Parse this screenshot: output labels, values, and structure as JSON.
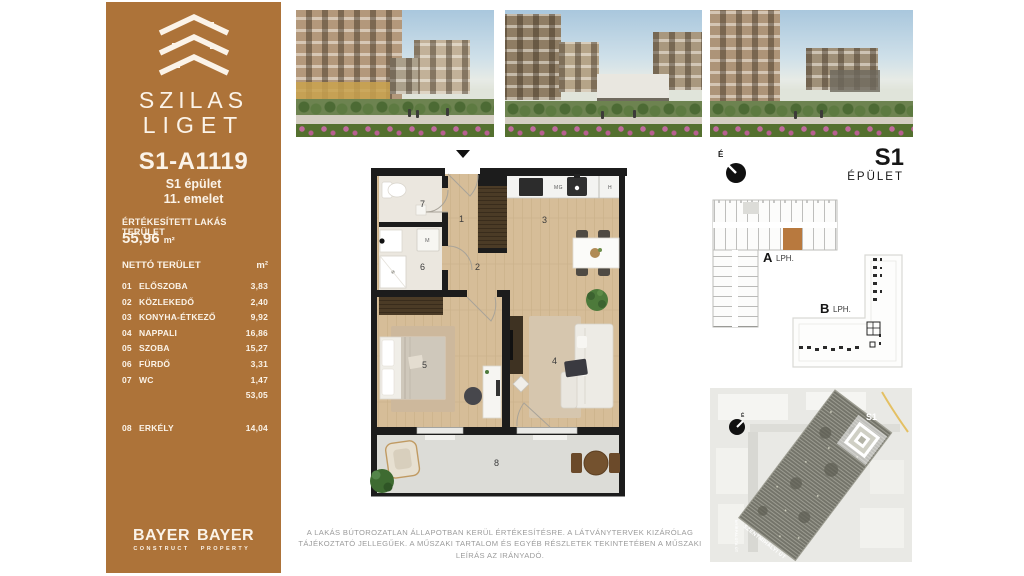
{
  "sidebar": {
    "accent_color": "#ad7339",
    "logo": {
      "line1": "SZILAS",
      "line2": "LIGET"
    },
    "unit_id": "S1-A1119",
    "building": "S1 épület",
    "floor": "11. emelet",
    "sold_area_label": "ÉRTÉKESÍTETT LAKÁS TERÜLET",
    "sold_area_value": "55,96",
    "sold_area_unit": "m²",
    "net_area_label": "NETTÓ TERÜLET",
    "net_area_unit": "m²",
    "rooms": [
      {
        "num": "01",
        "name": "ELŐSZOBA",
        "area": "3,83"
      },
      {
        "num": "02",
        "name": "KÖZLEKEDŐ",
        "area": "2,40"
      },
      {
        "num": "03",
        "name": "KONYHA-ÉTKEZŐ",
        "area": "9,92"
      },
      {
        "num": "04",
        "name": "NAPPALI",
        "area": "16,86"
      },
      {
        "num": "05",
        "name": "SZOBA",
        "area": "15,27"
      },
      {
        "num": "06",
        "name": "FÜRDŐ",
        "area": "3,31"
      },
      {
        "num": "07",
        "name": "WC",
        "area": "1,47"
      }
    ],
    "net_total": "53,05",
    "balcony_row": {
      "num": "08",
      "name": "ERKÉLY",
      "area": "14,04"
    },
    "brand1": {
      "name": "BAYER",
      "sub": "CONSTRUCT"
    },
    "brand2": {
      "name": "BAYER",
      "sub": "PROPERTY"
    }
  },
  "header_right": {
    "compass_letter": "É",
    "building_code": "S1",
    "building_label": "ÉPÜLET"
  },
  "schematic": {
    "a_label": "A",
    "a_sub": "LPH.",
    "b_label": "B",
    "b_sub": "LPH.",
    "highlight_color": "#b8793e"
  },
  "site_map": {
    "building_tag": "S1",
    "street1": "SZENTMIHÁLYI ÚT",
    "street2": "NYÍRPALOTA ÚT",
    "compass_letter": "É"
  },
  "floorplan": {
    "room_labels": [
      "1",
      "2",
      "3",
      "4",
      "5",
      "6",
      "7",
      "8"
    ],
    "labels": {
      "mg": "MG",
      "h": "H",
      "m": "M"
    }
  },
  "disclaimer": "A LAKÁS BÚTOROZATLAN ÁLLAPOTBAN KERÜL ÉRTÉKESÍTÉSRE. A LÁTVÁNYTERVEK KIZÁRÓLAG TÁJÉKOZTATÓ JELLEGŰEK. A MŰSZAKI TARTALOM ÉS EGYÉB RÉSZLETEK TEKINTETÉBEN A MŰSZAKI LEÍRÁS AZ IRÁNYADÓ."
}
